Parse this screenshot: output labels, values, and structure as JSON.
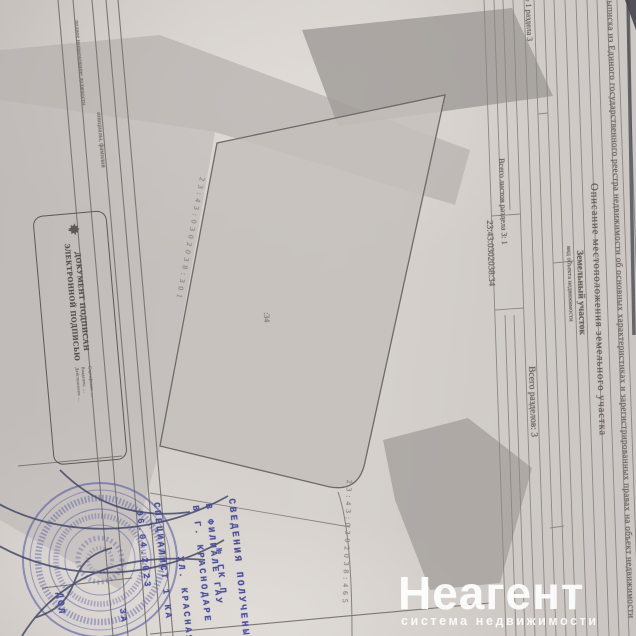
{
  "doc": {
    "title": "Выписка из Единого государственного реестра недвижимости об основных характеристиках и зарегистрированных правах на объект недвижимости",
    "section": {
      "name": "Описание местоположения земельного участка",
      "sheet": "Лист № 1 раздела 3",
      "total_sheets": "Всего листов раздела 3: 1",
      "total_sections": "Всего разделов: 3"
    },
    "object": {
      "type": "Земельный участок",
      "type_caption": "вид объекта недвижимости",
      "cadastral_number": "23:43:0302038:34"
    },
    "plan": {
      "parcel_label": ":34",
      "adjacent_left": "23:43:0302038:301",
      "adjacent_bottom": "23:43:0302038:465"
    },
    "signature_block": {
      "position_label": "полное наименование должности",
      "name_label": "инициалы, фамилия"
    },
    "esign": {
      "heading1": "ДОКУМЕНТ ПОДПИСАН",
      "heading2": "ЭЛЕКТРОННОЙ ПОДПИСЬЮ",
      "details": [
        "Сертификат: …",
        "Владелец: …",
        "Действителен: …"
      ]
    },
    "office_stamp": {
      "lines": [
        "СВЕДЕНИЯ ПОЛУЧЕНЫ",
        "№ ГК П",
        "В ФИЛИАЛЕ ГАУ",
        "В Г. КРАСНОДАРЕ",
        "УЛ. КРАСНАЯ",
        "СПЕЦИАЛИСТ 1 КА",
        "06.04.2023",
        "ЗА"
      ],
      "fragment": "ДОЛ",
      "ink_color": "#4b509a"
    }
  },
  "watermark": {
    "brand": "Неагент",
    "tagline": "система недвижимости",
    "color": "#ffffff"
  },
  "colors": {
    "paper": "#cfc9c6",
    "shading": "#b6b1ae",
    "stamp_ink": "#4b509a",
    "print": "#6b6560"
  }
}
